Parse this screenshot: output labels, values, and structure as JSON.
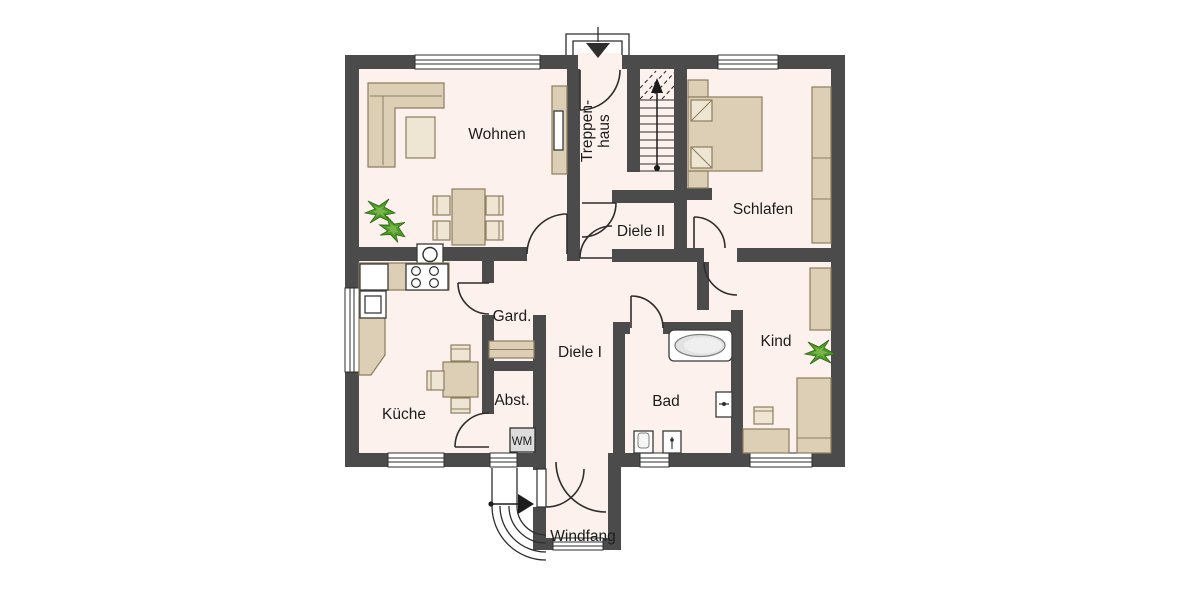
{
  "plan": {
    "type": "apartment-floor-plan",
    "language": "de",
    "rooms": {
      "wohnen": {
        "label": "Wohnen"
      },
      "treppenhaus": {
        "label_line1": "Treppen-",
        "label_line2": "haus"
      },
      "schlafen": {
        "label": "Schlafen"
      },
      "diele2": {
        "label": "Diele II"
      },
      "gard": {
        "label": "Gard."
      },
      "diele1": {
        "label": "Diele I"
      },
      "kueche": {
        "label": "Küche"
      },
      "abst": {
        "label": "Abst."
      },
      "bad": {
        "label": "Bad"
      },
      "kind": {
        "label": "Kind"
      },
      "windfang": {
        "label": "Windfang"
      }
    },
    "appliances": {
      "washing_machine": "WM"
    },
    "colors": {
      "wall": "#4b4b4b",
      "floor": "#fcf1ec",
      "furniture": "#dccfb5",
      "furniture_stroke": "#8d7d5f",
      "furniture_light": "#eee5d2",
      "plant_green": "#4f9928",
      "window_fill": "#ffffff",
      "line": "#2e2e2e"
    }
  }
}
